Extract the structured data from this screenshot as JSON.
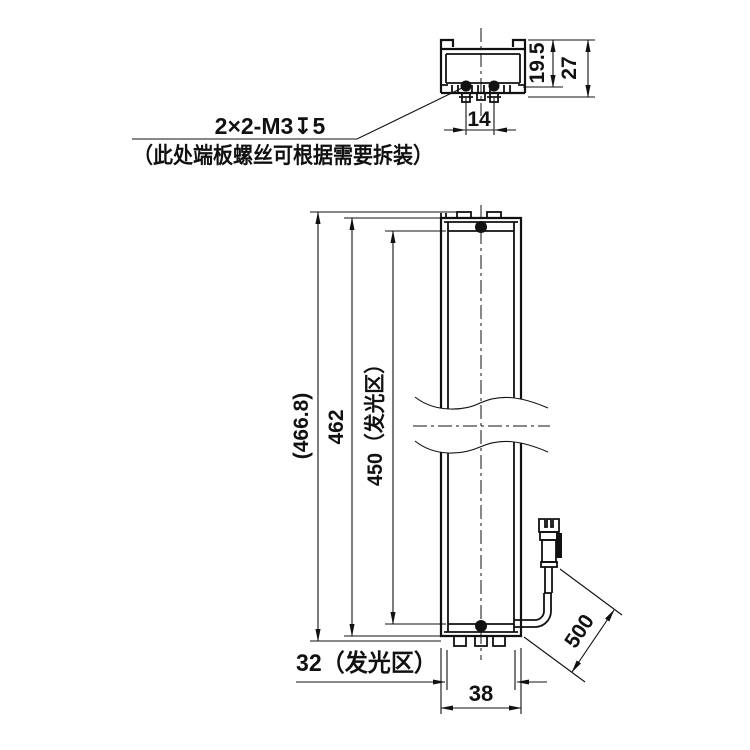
{
  "title_note": {
    "line1": "2×2-M3↧5",
    "line2": "（此处端板螺丝可根据需要拆装）"
  },
  "section_view": {
    "slot_depth": "19.5",
    "total_height": "27",
    "screw_spacing": "14"
  },
  "front_view": {
    "overall_length": "(466.8)",
    "body_length": "462",
    "glow_length": "450（发光区）",
    "glow_width": "32（发光区）",
    "body_width": "38",
    "cable_length": "500"
  },
  "colors": {
    "line": "#111111",
    "background": "#ffffff"
  }
}
